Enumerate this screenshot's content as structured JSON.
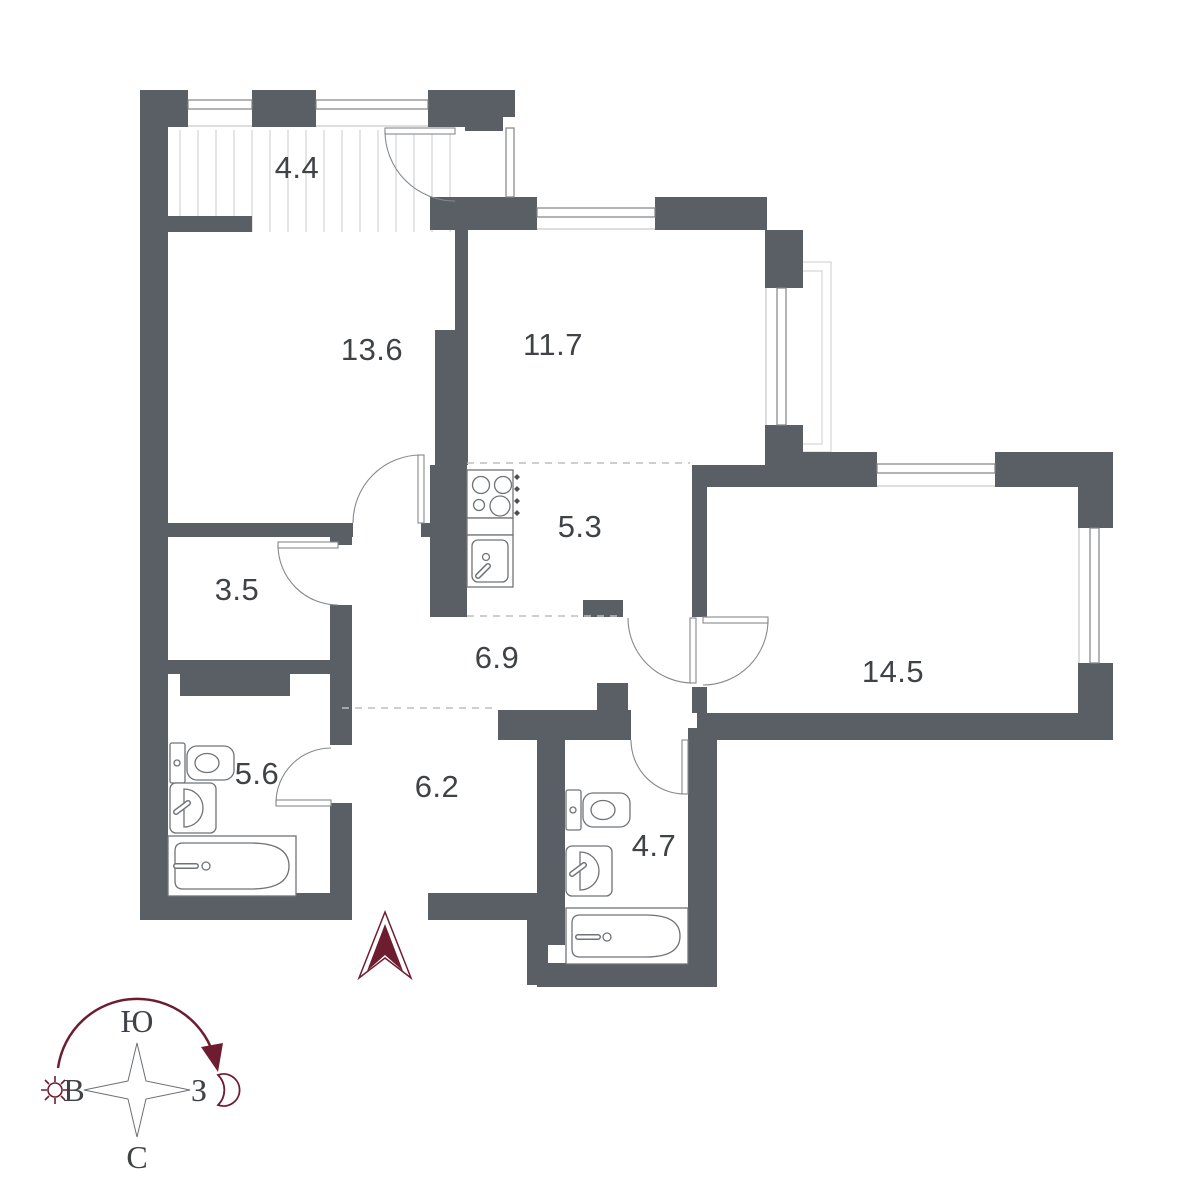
{
  "plan": {
    "type": "apartment floor plan",
    "rooms": [
      {
        "name": "loggia",
        "area": "4.4"
      },
      {
        "name": "bedroom",
        "area": "13.6"
      },
      {
        "name": "room",
        "area": "11.7"
      },
      {
        "name": "kitchen",
        "area": "5.3"
      },
      {
        "name": "storage",
        "area": "3.5"
      },
      {
        "name": "hall",
        "area": "6.9"
      },
      {
        "name": "living-room",
        "area": "14.5"
      },
      {
        "name": "bathroom-1",
        "area": "5.6"
      },
      {
        "name": "hallway",
        "area": "6.2"
      },
      {
        "name": "bathroom-2",
        "area": "4.7"
      }
    ],
    "compass": {
      "top": "Ю",
      "bottom": "С",
      "left": "В",
      "right": "З"
    },
    "colors": {
      "wall": "#5a5e65",
      "accent": "#6e1d31",
      "label": "#3f4347",
      "fixture_line": "#6f7377",
      "hatch": "#c9cbcd",
      "dashed": "#bcbec0",
      "balcony_outline": "#dcdee0"
    }
  }
}
